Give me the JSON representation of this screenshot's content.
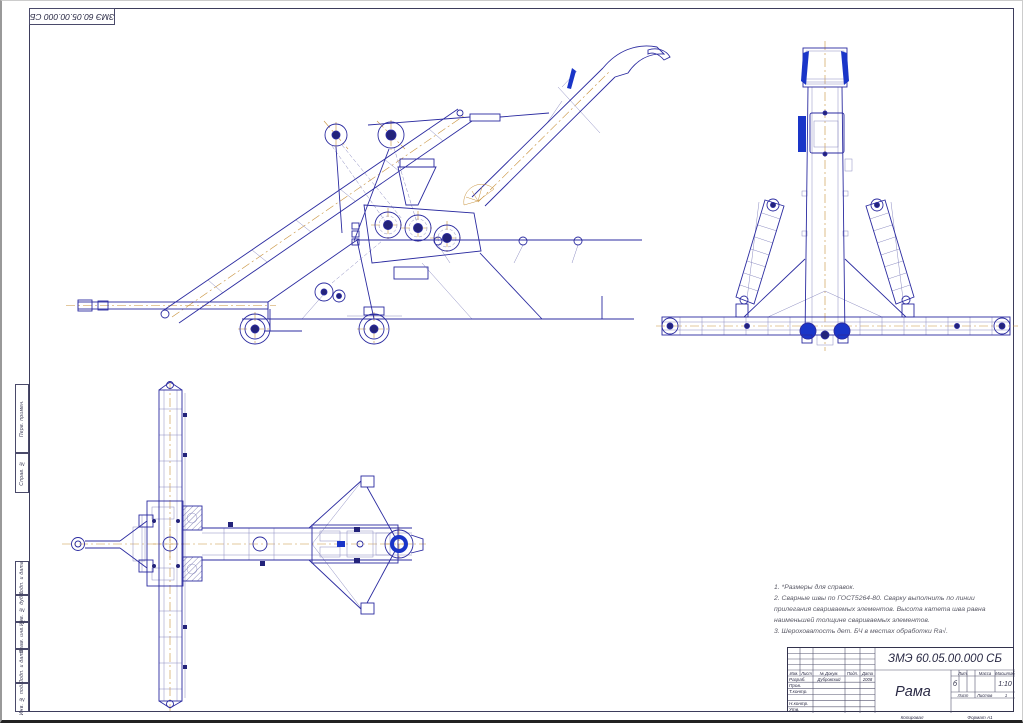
{
  "colors": {
    "main_line": "#2b2ba0",
    "thin_line": "#8a8ac0",
    "accent_centerline": "#c8923c",
    "solid_blue": "#1a35c8",
    "frame_line": "#3d3d5c"
  },
  "corner_stamp": {
    "text": "ЗМЭ 60.05.00.000 СБ"
  },
  "margin_labels": {
    "items": [
      "Перв. примен.",
      "Справ. №",
      "Подп. и дата",
      "Инв. № дубл.",
      "Взам. инв. №",
      "Подп. и дата",
      "Инв. № подл."
    ]
  },
  "views": {
    "side_view": "side view of grain thrower on wheeled frame",
    "front_view": "rear view with twin inclined feeders and transverse beam",
    "plan_view": "top view of frame with drawbar"
  },
  "notes": {
    "lines": [
      "1. *Размеры для справок.",
      "2. Сварные швы по ГОСТ5264-80. Сварку выполнить по линии",
      "прилегания свариваемых элементов. Высота катета шва равна",
      "наименьшей толщине свариваемых элементов.",
      "3. Шероховатость дет. БЧ в местах обработки Ra√."
    ]
  },
  "title_block": {
    "doc_number": "ЗМЭ 60.05.00.000 СБ",
    "title": "Рама",
    "rev_header": {
      "izm": "Изм.",
      "list": "Лист",
      "dokum": "№ Докум.",
      "podp": "Подп.",
      "data": "Дата"
    },
    "rows": [
      {
        "label": "Разраб.",
        "name": "Дубровский",
        "date": "2008"
      },
      {
        "label": "Пров.",
        "name": "",
        "date": ""
      },
      {
        "label": "Т.контр.",
        "name": "",
        "date": ""
      },
      {
        "label": "",
        "name": "",
        "date": ""
      },
      {
        "label": "Н.контр.",
        "name": "",
        "date": ""
      },
      {
        "label": "Утв.",
        "name": "",
        "date": ""
      }
    ],
    "lit_label": "Лит.",
    "lit_value": "б",
    "mass_label": "Масса",
    "mass_value": "",
    "scale_label": "Масштаб",
    "scale_value": "1:10",
    "sheet_label": "Лист",
    "sheets_label": "Листов",
    "sheets_value": "1"
  },
  "footer": {
    "copied": "Копировал",
    "format": "Формат  А1"
  }
}
